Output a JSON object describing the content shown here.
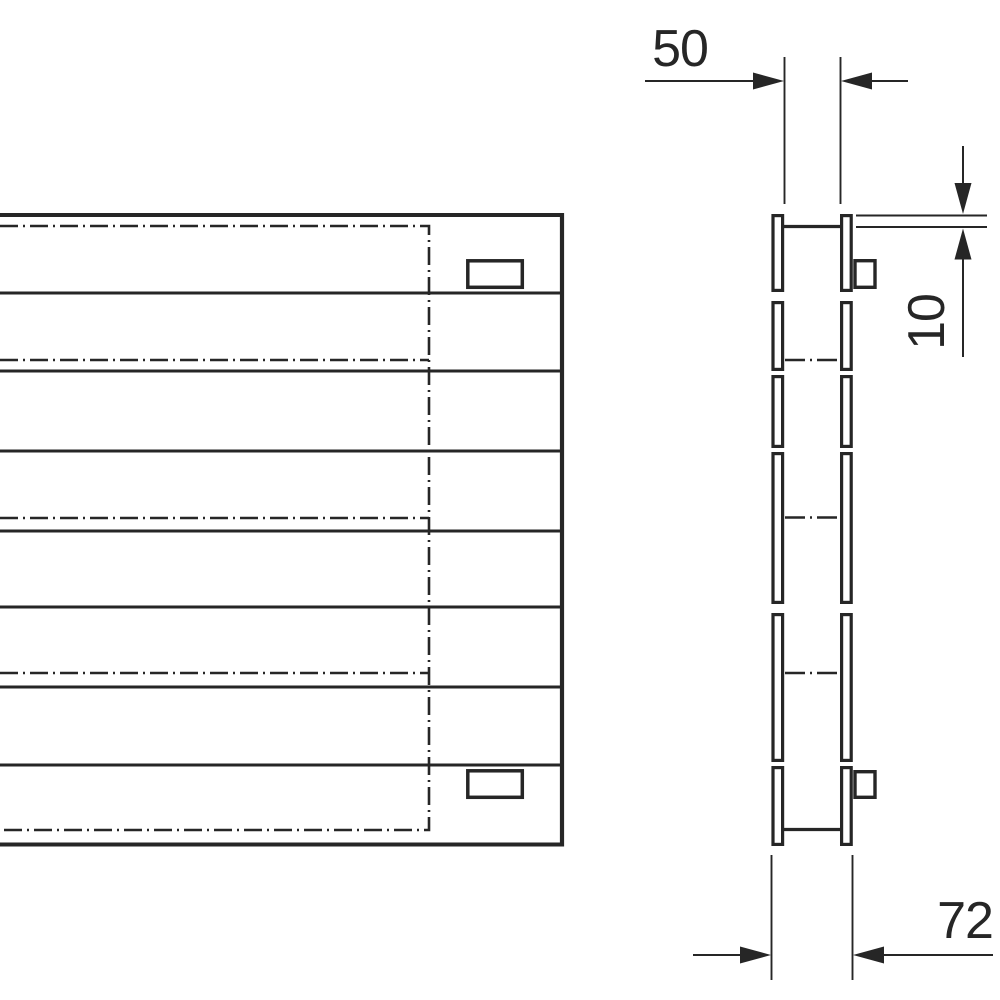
{
  "page": {
    "background_color": "#ffffff",
    "line_color": "#262626",
    "description": "technical-drawing"
  },
  "drawing": {
    "views": {
      "front_view": "radiator-front-elevation",
      "side_view": "radiator-side-profile"
    },
    "dimensions": {
      "inner_depth": {
        "value": "50"
      },
      "top_offset": {
        "value": "10"
      },
      "overall_depth": {
        "value": "72"
      }
    }
  }
}
